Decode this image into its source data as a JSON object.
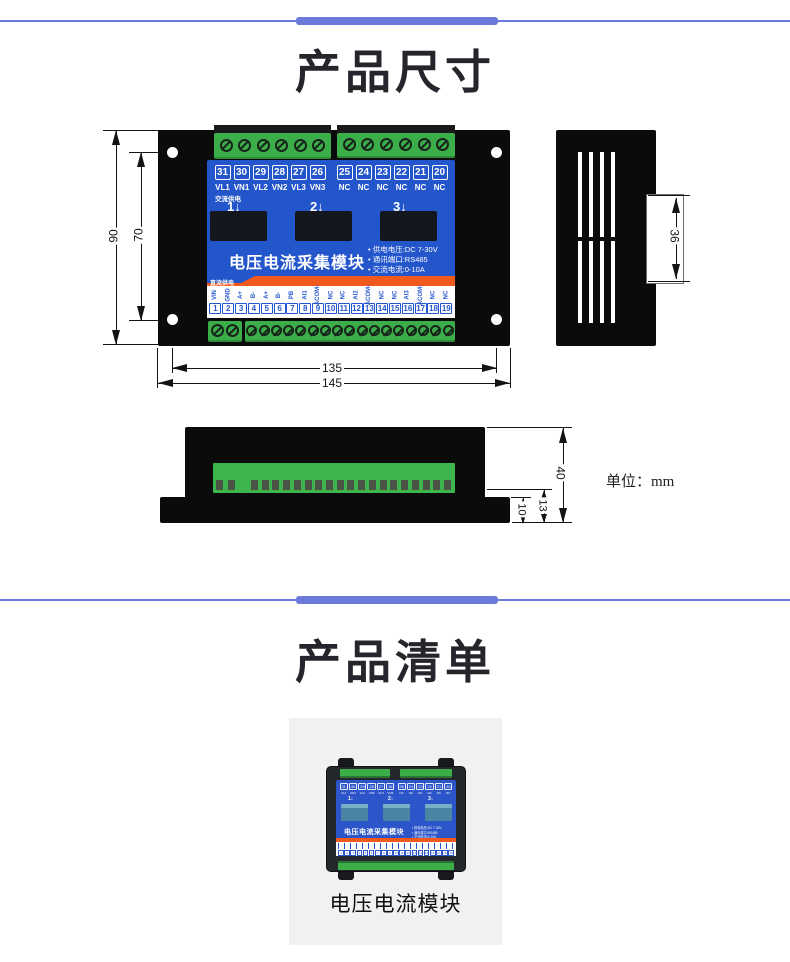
{
  "colors": {
    "accent": "#6b7ad8",
    "panel": "#2355cb",
    "orange": "#f2591d",
    "green": "#3cae49",
    "case": "#0b0b0c"
  },
  "section_dimensions": {
    "title": "产品尺寸",
    "unit_label": "单位：mm",
    "front_view": {
      "dims": {
        "outer_height": "90",
        "inner_height": "70",
        "inner_width": "135",
        "outer_width": "145"
      },
      "top_terminals_left": [
        {
          "num": "31",
          "label": "VL1"
        },
        {
          "num": "30",
          "label": "VN1"
        },
        {
          "num": "29",
          "label": "VL2"
        },
        {
          "num": "28",
          "label": "VN2"
        },
        {
          "num": "27",
          "label": "VL3"
        },
        {
          "num": "26",
          "label": "VN3"
        }
      ],
      "top_terminals_right": [
        {
          "num": "25",
          "label": "NC"
        },
        {
          "num": "24",
          "label": "NC"
        },
        {
          "num": "23",
          "label": "NC"
        },
        {
          "num": "22",
          "label": "NC"
        },
        {
          "num": "21",
          "label": "NC"
        },
        {
          "num": "20",
          "label": "NC"
        }
      ],
      "ac_power_label": "交流供电",
      "channel_markers": [
        "1↓",
        "2↓",
        "3↓"
      ],
      "module_title": "电压电流采集模块",
      "specs": [
        "• 供电电压:DC 7-30V",
        "• 通讯端口:RS485",
        "• 交流电流:0-10A"
      ],
      "dc_power_label": "直流供电",
      "bottom_terminals": [
        {
          "num": "1",
          "label": "VIN"
        },
        {
          "num": "2",
          "label": "GND"
        },
        {
          "num": "3",
          "label": "A+"
        },
        {
          "num": "4",
          "label": "B-"
        },
        {
          "num": "5",
          "label": "A+"
        },
        {
          "num": "6",
          "label": "B-"
        },
        {
          "num": "7",
          "label": "PB"
        },
        {
          "num": "8",
          "label": "AI1"
        },
        {
          "num": "9",
          "label": "ACOM-"
        },
        {
          "num": "10",
          "label": "NC"
        },
        {
          "num": "11",
          "label": "NC"
        },
        {
          "num": "12",
          "label": "AI2"
        },
        {
          "num": "13",
          "label": "ACOM-"
        },
        {
          "num": "14",
          "label": "NC"
        },
        {
          "num": "15",
          "label": "NC"
        },
        {
          "num": "16",
          "label": "AI3"
        },
        {
          "num": "17",
          "label": "ACOM-"
        },
        {
          "num": "18",
          "label": "NC"
        },
        {
          "num": "19",
          "label": "NC"
        }
      ]
    },
    "side_view": {
      "dim_width": "36"
    },
    "bottom_view": {
      "dims": {
        "total_height": "40",
        "terminal_height": "13",
        "base_height": "10"
      }
    }
  },
  "section_list": {
    "title": "产品清单",
    "item": {
      "caption": "电压电流模块"
    }
  }
}
